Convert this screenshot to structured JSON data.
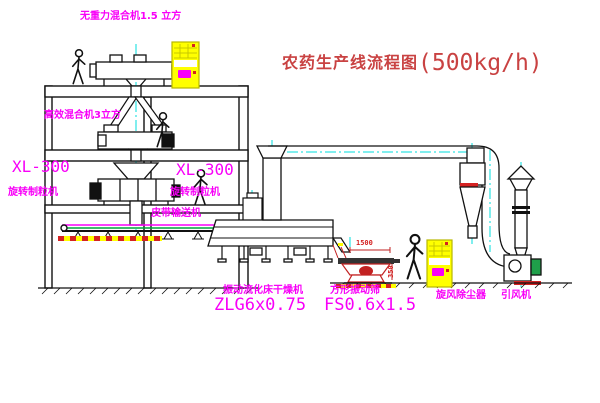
{
  "title": {
    "cn": "农药生产线流程图",
    "capacity": "(500kg/h)"
  },
  "labels": {
    "top_mixer": "无重力混合机1.5 立方",
    "mid_mixer": "高效混合机3立方",
    "granulator_left_model": "XL-300",
    "granulator_left_name": "旋转制粒机",
    "granulator_right_model": "XL-300",
    "granulator_right_name": "旋转制粒机",
    "belt_conveyor": "皮带输送机",
    "dryer_name": "振动流化床干燥机",
    "dryer_model": "ZLG6x0.75",
    "sieve_name": "方形振动筛",
    "sieve_model": "FS0.6x1.5",
    "cyclone": "旋风除尘器",
    "fan": "引风机"
  },
  "dimensions": {
    "sieve_length": "1500",
    "sieve_outlet": "350"
  },
  "palette": {
    "label_magenta": "#f800f8",
    "title_red": "#c94242",
    "dimension_red": "#d42222",
    "centerline_cyan": "#00dcdc",
    "cabinet_yellow": "#ffff00",
    "conveyor_green": "#00a33c",
    "line_black": "#111111"
  }
}
